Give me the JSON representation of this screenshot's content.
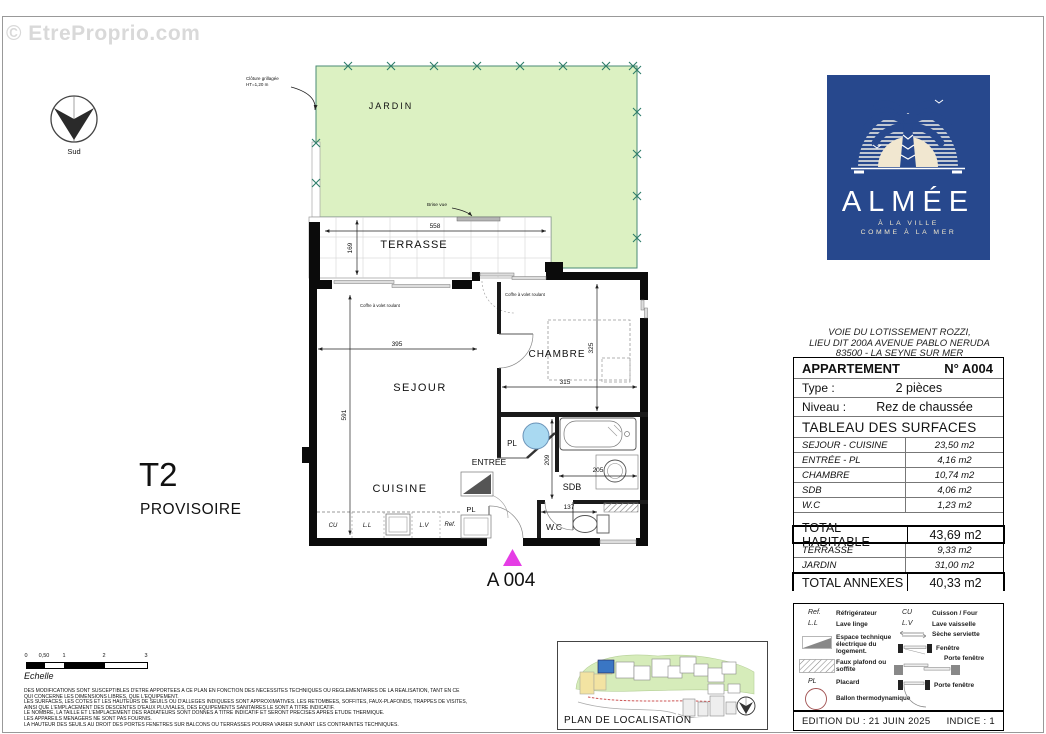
{
  "watermark": "© EtreProprio.com",
  "compass": {
    "south_label": "Sud"
  },
  "plan": {
    "rooms": {
      "jardin": "JARDIN",
      "terrasse": "TERRASSE",
      "sejour": "SEJOUR",
      "cuisine": "CUISINE",
      "chambre": "CHAMBRE",
      "entree": "ENTREE",
      "sdb": "SDB",
      "wc": "W.C",
      "pl": "PL"
    },
    "type_label": "T2",
    "status_label": "PROVISOIRE",
    "unit_label": "A 004",
    "dims": {
      "terrasse_w": "558",
      "terrasse_d": "169",
      "sejour_w": "395",
      "sejour_h": "591",
      "chambre_w": "315",
      "chambre_h": "325",
      "sdb_h": "209",
      "sdb_w": "205",
      "wc_w": "137"
    },
    "appliances": {
      "cu": "CU",
      "ll": "L.L",
      "lv": "L.V",
      "ref": "Ref."
    },
    "annotations": {
      "cloture_line1": "Clôture grillagée",
      "cloture_line2": "HT=1,20 m",
      "brise_vue": "Brise vue",
      "coffre": "Coffre à volet roulant"
    }
  },
  "logo": {
    "name": "ALMÉE",
    "tagline1": "À LA VILLE",
    "tagline2": "COMME À LA MER",
    "background": "#27488d"
  },
  "address": {
    "line1": "VOIE DU LOTISSEMENT ROZZI,",
    "line2": "LIEU DIT 200A AVENUE PABLO NERUDA",
    "line3": "83500 - LA SEYNE SUR MER"
  },
  "table": {
    "header": {
      "label": "APPARTEMENT",
      "value": "N° A004"
    },
    "type": {
      "label": "Type :",
      "value": "2 pièces"
    },
    "niveau": {
      "label": "Niveau :",
      "value": "Rez de chaussée"
    },
    "surfaces_title": "TABLEAU DES SURFACES",
    "surfaces": [
      {
        "label": "SEJOUR - CUISINE",
        "value": "23,50 m2"
      },
      {
        "label": "ENTRÉE - PL",
        "value": "4,16 m2"
      },
      {
        "label": "CHAMBRE",
        "value": "10,74 m2"
      },
      {
        "label": "SDB",
        "value": "4,06 m2"
      },
      {
        "label": "W.C",
        "value": "1,23 m2"
      }
    ],
    "total_habitable": {
      "label": "TOTAL HABITABLE",
      "value": "43,69 m2"
    },
    "annexes": [
      {
        "label": "TERRASSE",
        "value": "9,33 m2"
      },
      {
        "label": "JARDIN",
        "value": "31,00 m2"
      }
    ],
    "total_annexes": {
      "label": "TOTAL ANNEXES",
      "value": "40,33 m2"
    }
  },
  "legend": {
    "left": [
      {
        "symbol": "Ref.",
        "label": "Réfrigérateur"
      },
      {
        "symbol": "L.L",
        "label": "Lave linge"
      },
      {
        "icon": "electrical-space-icon",
        "label": "Espace technique électrique du logement."
      },
      {
        "icon": "false-ceiling-hatch-icon",
        "label": "Faux plafond ou soffite"
      },
      {
        "symbol": "PL",
        "label": "Placard"
      },
      {
        "icon": "thermodynamic-tank-icon",
        "label": "Ballon thermodynamique"
      }
    ],
    "right": [
      {
        "symbol": "CU",
        "label": "Cuisson / Four"
      },
      {
        "symbol": "L.V",
        "label": "Lave vaisselle"
      },
      {
        "icon": "towel-dryer-icon",
        "label": "Sèche serviette"
      },
      {
        "icon": "window-icon",
        "label": "Fenêtre"
      },
      {
        "icon": "sliding-door-window-icon",
        "label": "Porte fenêtre"
      },
      {
        "icon": "hinged-door-window-icon",
        "label": "Porte fenêtre"
      }
    ]
  },
  "footer": {
    "edition": "EDITION DU : 21 JUIN 2025",
    "indice": "INDICE : 1"
  },
  "scale": {
    "ticks": [
      "0",
      "0,50",
      "1",
      "2",
      "3"
    ],
    "label": "Echelle"
  },
  "disclaimer": {
    "lines": [
      "DES MODIFICATIONS SONT SUSCEPTIBLES D'ETRE APPORTEES A CE PLAN EN FONCTION DES NECESSITES TECHNIQUES OU REGLEMENTAIRES DE LA REALISATION, TANT EN CE",
      "QUI CONCERNE LES DIMENSIONS LIBRES, QUE L'EQUIPEMENT.",
      "LES SURFACES, LES COTES ET LES HAUTEURS DE SEUILS OU D'ALLEGES INDIQUEES SONT APPROXIMATIVES. LES RETOMBEES, SOFFITES, FAUX-PLAFONDS, TRAPPES DE VISITES,",
      "AINSI QUE L'EMPLACEMENT DES DESCENTES D'EAUX PLUVIALES, DES EQUIPEMENTS SANITAIRES  LE SONT A TITRE INDICATIF.",
      "LE NOMBRE, LA TAILLE ET L'EMPLACEMENT DES RADIATEURS SONT DONNES A TITRE INDICATIF ET SERONT PRECISES APRES ETUDE THERMIQUE.",
      "LES APPAREILS MENAGERS NE SONT PAS FOURNIS.",
      "LA HAUTEUR DES SEUILS AU DROIT DES PORTES FENETRES SUR BALCONS OU TERRASSES POURRA VARIER SUIVANT LES CONTRAINTES TECHNIQUES."
    ]
  },
  "localisation": {
    "title": "PLAN DE LOCALISATION"
  },
  "colors": {
    "jardin_green": "#dcf1c2",
    "fence_teal": "#4a8a74",
    "logo_blue": "#27488d",
    "marker_magenta": "#e53de5",
    "provisoire_red": "#c0392b",
    "ballon_blue": "#a9d9f1"
  }
}
